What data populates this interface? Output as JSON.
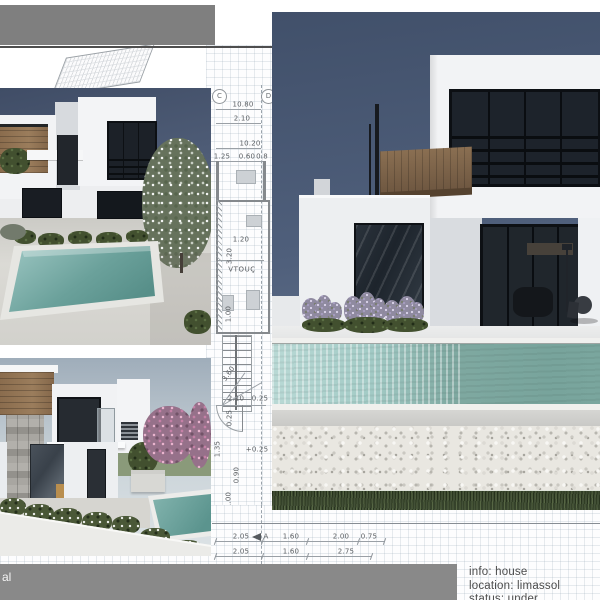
{
  "footer": {
    "bar_text": "al",
    "info": {
      "line1": "info: house",
      "line2": "location: limassol",
      "line3": "status: under construction"
    }
  },
  "blueprint": {
    "marker_c": "C",
    "marker_d": "D",
    "d1080": "10.80",
    "d210a": "2.10",
    "d1020": "10.20",
    "d125": "1.25",
    "d060": "0.60",
    "d08": "0.8",
    "d120": "1.20",
    "d320": "3.20",
    "room_label": "VTOUÇ",
    "d100a": "1.00",
    "d360": "3.60",
    "d210b": "2.10",
    "d025a": "0.25",
    "d025b": "0.25",
    "dp025": "+0.25",
    "d135": "1.35",
    "d090": "0.90",
    "d100b": "1.00",
    "section_marker": "A",
    "row1": [
      "2.05",
      "1.60",
      "2.00",
      "0.75"
    ],
    "row2": [
      "2.05",
      "1.60",
      "2.75"
    ]
  },
  "colors": {
    "header_bar": "#7f7f7f",
    "footer_bar": "#898989",
    "night_sky_top": "#41506a",
    "night_sky_bottom": "#70809a",
    "day_sky_top": "#9fadba",
    "day_sky_bottom": "#dde3e6",
    "pool_water_light": "#a3cbc6",
    "pool_water_dark": "#578f89",
    "wood_cladding": "#8a6c4d",
    "stone_gray": "#a09e99",
    "grass_green": "#46543a",
    "pebble_white": "#e9e7e1",
    "blossom_pink": "#d395b8",
    "lavender_purple": "#a89ec2",
    "blueprint_line": "#9aa0a6",
    "dim_text": "#595d61",
    "info_text": "#4c4c4c"
  }
}
